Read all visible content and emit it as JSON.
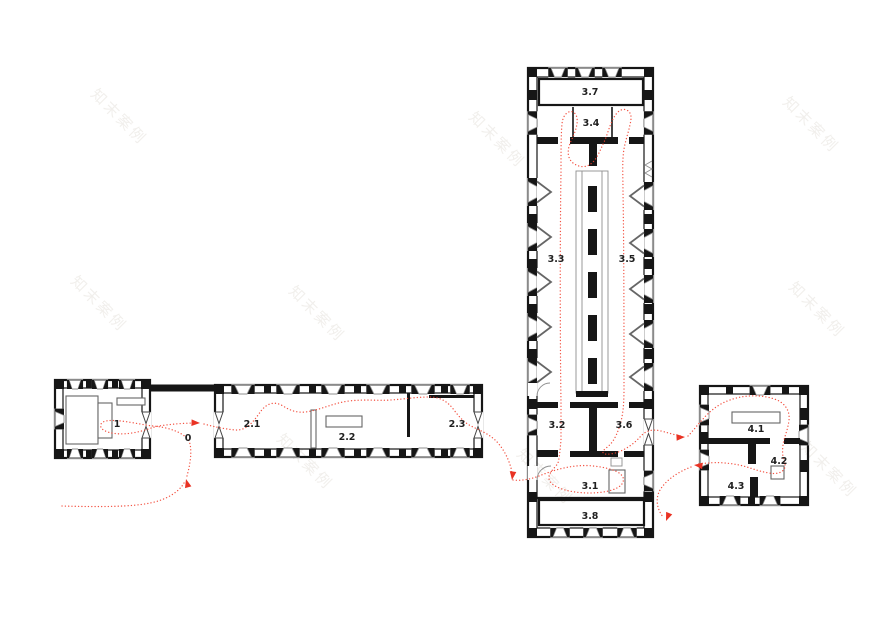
{
  "page": {
    "kind": "architectural-floor-plan"
  },
  "colors": {
    "wall": "#161616",
    "thin": "#8f8f8f",
    "route": "#f2402f",
    "arrow": "#e93223",
    "label": "#1f1f1f",
    "watermark": "#f1efec",
    "background": "#ffffff"
  },
  "watermark": {
    "text": "知末案例"
  },
  "plan": {
    "buildings": [
      {
        "name": "entry-pavilion",
        "rooms": [
          {
            "label": "1"
          }
        ]
      },
      {
        "name": "link-court",
        "rooms": [
          {
            "label": "0"
          }
        ]
      },
      {
        "name": "long-gallery",
        "rooms": [
          {
            "label": "2.1"
          },
          {
            "label": "2.2"
          },
          {
            "label": "2.3"
          }
        ]
      },
      {
        "name": "main-hall",
        "rooms": [
          {
            "label": "3.7"
          },
          {
            "label": "3.4"
          },
          {
            "label": "3.3"
          },
          {
            "label": "3.5"
          },
          {
            "label": "3.2"
          },
          {
            "label": "3.6"
          },
          {
            "label": "3.1"
          },
          {
            "label": "3.8"
          }
        ]
      },
      {
        "name": "annex",
        "rooms": [
          {
            "label": "4.1"
          },
          {
            "label": "4.2"
          },
          {
            "label": "4.3"
          }
        ]
      }
    ],
    "route": {
      "style": "dotted",
      "color": "#f2402f",
      "arrow_count": 6
    }
  }
}
